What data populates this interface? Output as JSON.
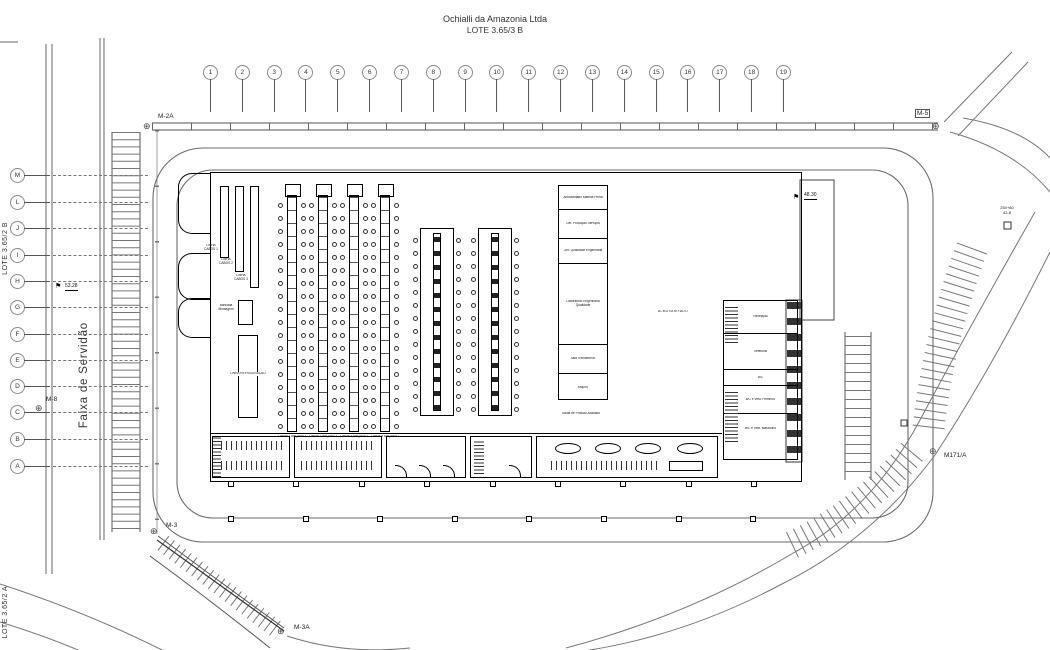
{
  "title": {
    "company": "Ochialli da Amazonia Ltda",
    "lot": "LOTE 3.65/3 B"
  },
  "grid": {
    "columns": [
      "1",
      "2",
      "3",
      "4",
      "5",
      "6",
      "7",
      "8",
      "9",
      "10",
      "11",
      "12",
      "13",
      "14",
      "15",
      "16",
      "17",
      "18",
      "19"
    ],
    "rows": [
      "M",
      "L",
      "J",
      "I",
      "H",
      "G",
      "F",
      "E",
      "D",
      "C",
      "B",
      "A"
    ]
  },
  "site_labels": {
    "lote_left": "LOTE 3.65/2 B",
    "lote_bottom_left": "LOTE 3.65/2 A",
    "servidao": "Faixa de Servidão",
    "station_line1": "250+80",
    "station_line2": "42-8"
  },
  "markers": [
    {
      "id": "m2a",
      "label": "M-2A"
    },
    {
      "id": "m5",
      "label": "M-5"
    },
    {
      "id": "m8",
      "label": "M-8"
    },
    {
      "id": "m3",
      "label": "M-3"
    },
    {
      "id": "m3a",
      "label": "M-3A"
    },
    {
      "id": "m171a",
      "label": "M171/A"
    }
  ],
  "elevations": [
    {
      "id": "west",
      "value": "53.28"
    },
    {
      "id": "dock",
      "value": "48.30"
    }
  ],
  "building": {
    "mid_rooms": [
      "Almoxarifado Matéria Prima",
      "Ger. Produção Serviços",
      "Ger. Qualidade Engenharia",
      "Laboratório Engenharia Qualidade",
      "Sala Treinamento",
      "Arquivo"
    ],
    "mid_rooms_note": "Saída de Produto Acabado",
    "right_rooms": [
      "Recepção",
      "Refeitório",
      "WC",
      "WC e Vest. Feminino",
      "WC e Vest. Masculino"
    ],
    "storage_label": "ALMOXARIFADO",
    "line_racks": [
      "LINHA 1 ARQUIVO",
      "LINHA 2 ARQUIVO",
      "LINHA 3 ARQUIVO",
      "LINHA 4 ARQUIVO"
    ],
    "cable_racks": [
      "LINHA CABOS 1",
      "LINHA CABOS 2",
      "LINHA CABOS 3"
    ],
    "small_box_label": "Bancada Montagem",
    "tall_box_label": "LINHA REFRIGERAÇÃO"
  }
}
